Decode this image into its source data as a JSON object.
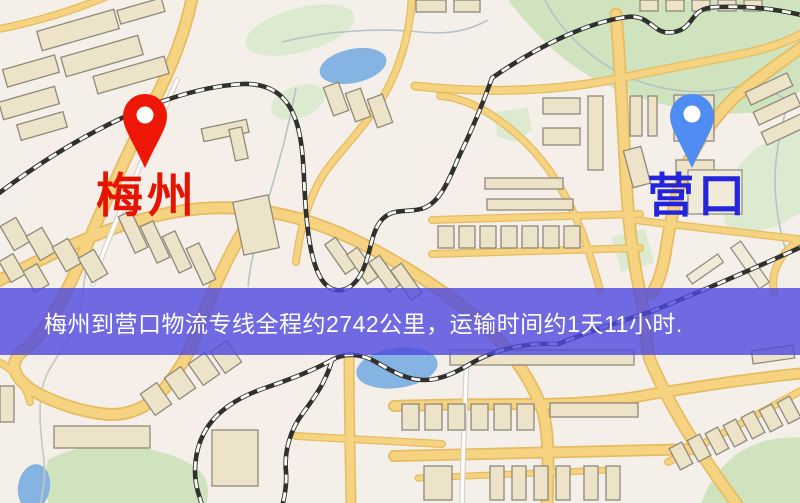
{
  "banner": {
    "text": "梅州到营口物流专线全程约2742公里，运输时间约1天11小时.",
    "background_color": "#4d48de",
    "text_color": "#ffffff"
  },
  "origin": {
    "name": "梅州",
    "pin_color": "#ee1708",
    "label_color": "#e51300"
  },
  "destination": {
    "name": "营口",
    "pin_color": "#4f8df2",
    "label_color": "#2424dd"
  },
  "map": {
    "background_color": "#f4efe8",
    "road_color": "#f6d381",
    "water_color": "#85b4e2",
    "park_color": "#cfe3bf",
    "building_color": "#ece3c8",
    "railway_dark": "#30302e",
    "railway_light": "#fafaf8"
  }
}
